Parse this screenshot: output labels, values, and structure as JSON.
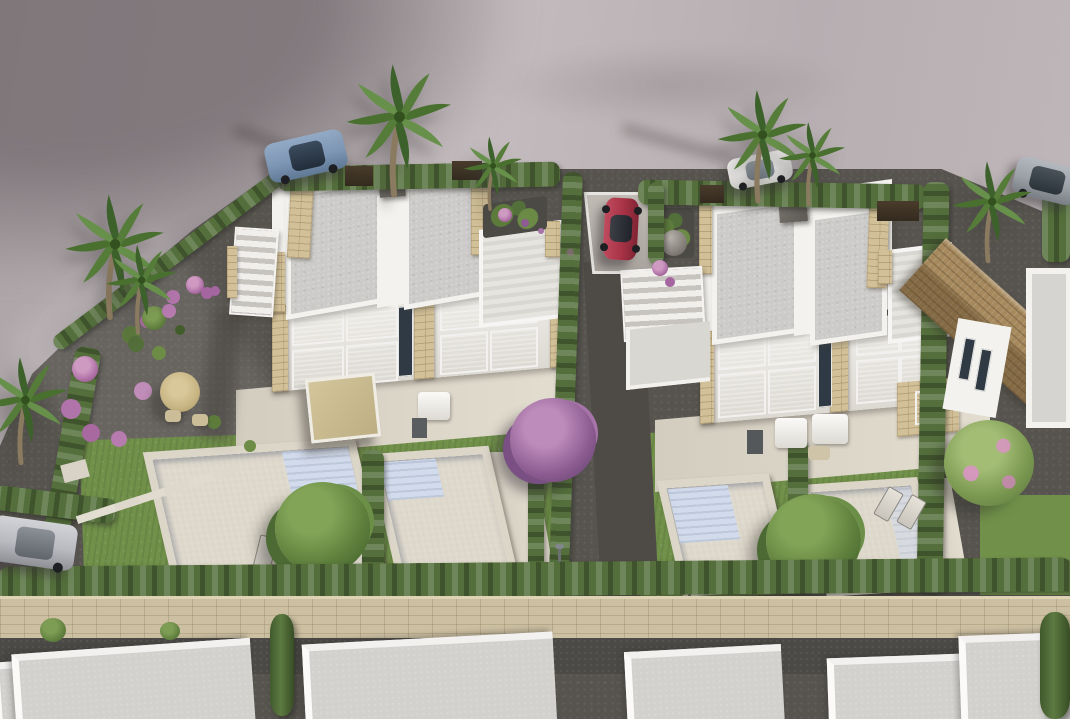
{
  "scene": {
    "type": "3d-architectural-aerial-render",
    "description": "Bird's-eye 3D rendering of a new-build residential development: two modern white duplex villas with flat grey roofs, beige stone-clad pillars, roof terraces and external stairs, front patios with furniture and straw parasol, four private swimming pools in lawned gardens separated by cypress hedges, a gravel ornamental garden with pink flowering shrubs and palm trees on the left, a curving grey road above with parked cars, a stone boundary wall and a row of existing white flat-roofed houses below, and an existing tile-roofed house on the right.",
    "visible_text": []
  },
  "palette": {
    "road": "#bdb5b7",
    "gravel": "#57544f",
    "grass": "#71914a",
    "hedge": "#546f3b",
    "cypress": "#4c6833",
    "tree_green": "#5d7f3c",
    "flower_pink": "#a868a0",
    "flower_purple": "#8d5c92",
    "pool_water": "#b1c2de",
    "pool_steps": "#d2dcee",
    "deck": "#dcd6c9",
    "patio": "#ddd7ca",
    "villa_white": "#f3f2ef",
    "roof_gray": "#cccbc9",
    "stone": "#d2c098",
    "wall_stone": "#cdc0a2",
    "tile_roof": "#a68a5e",
    "window_glass": "#46525e",
    "umbrella": "#c8b584",
    "trunk": "#8a7a5f",
    "car_blue": "#7d96b4",
    "car_red": "#a83246",
    "car_white": "#e8e7e5",
    "car_silver": "#b9bac0",
    "car_gray": "#9aa0a6"
  },
  "objects": {
    "villas": [
      {
        "id": "villa-left",
        "style": "modern white duplex, flat roof, two roof panels, roof terrace, stone pillars, glazed facade with blinds",
        "pools": 2
      },
      {
        "id": "villa-right",
        "style": "modern white duplex, flat roof, external staircase, roof terrace, stone accents",
        "pools": 2
      }
    ],
    "pools": [
      {
        "id": "pool-1",
        "villa": "villa-left",
        "shape": "rectangular",
        "feature": "corner entry steps"
      },
      {
        "id": "pool-2",
        "villa": "villa-left",
        "shape": "rectangular",
        "feature": "entry steps"
      },
      {
        "id": "pool-3",
        "villa": "villa-right",
        "shape": "rectangular",
        "feature": "wide side steps"
      },
      {
        "id": "pool-4",
        "villa": "villa-right",
        "shape": "rectangular"
      }
    ],
    "cars": [
      {
        "id": "car-blue",
        "color_name": "blue",
        "location": "road, top left"
      },
      {
        "id": "car-white",
        "color_name": "white",
        "location": "road, top middle"
      },
      {
        "id": "car-suv-grey",
        "color_name": "grey SUV",
        "location": "road, top right"
      },
      {
        "id": "car-red",
        "color_name": "red",
        "location": "driveway between villas"
      },
      {
        "id": "car-silver",
        "color_name": "silver",
        "location": "lane, bottom left"
      }
    ],
    "vegetation": {
      "palm_trees": 8,
      "cypress_hedgerows": 12,
      "flowering_shrubs_pink": 10,
      "green_shrubs": 6,
      "large_trees": 4,
      "lawns": 3
    },
    "furniture": [
      "straw parasol with chairs",
      "beige patio pergola",
      "white garden sofas",
      "sun loungers",
      "outdoor storage boxes",
      "garden lamps",
      "stepping-stone path"
    ],
    "other_structures": [
      "stone boundary wall",
      "row of flat-roofed houses at bottom",
      "tile-roofed house at right",
      "dark timber gates in top hedges"
    ]
  }
}
